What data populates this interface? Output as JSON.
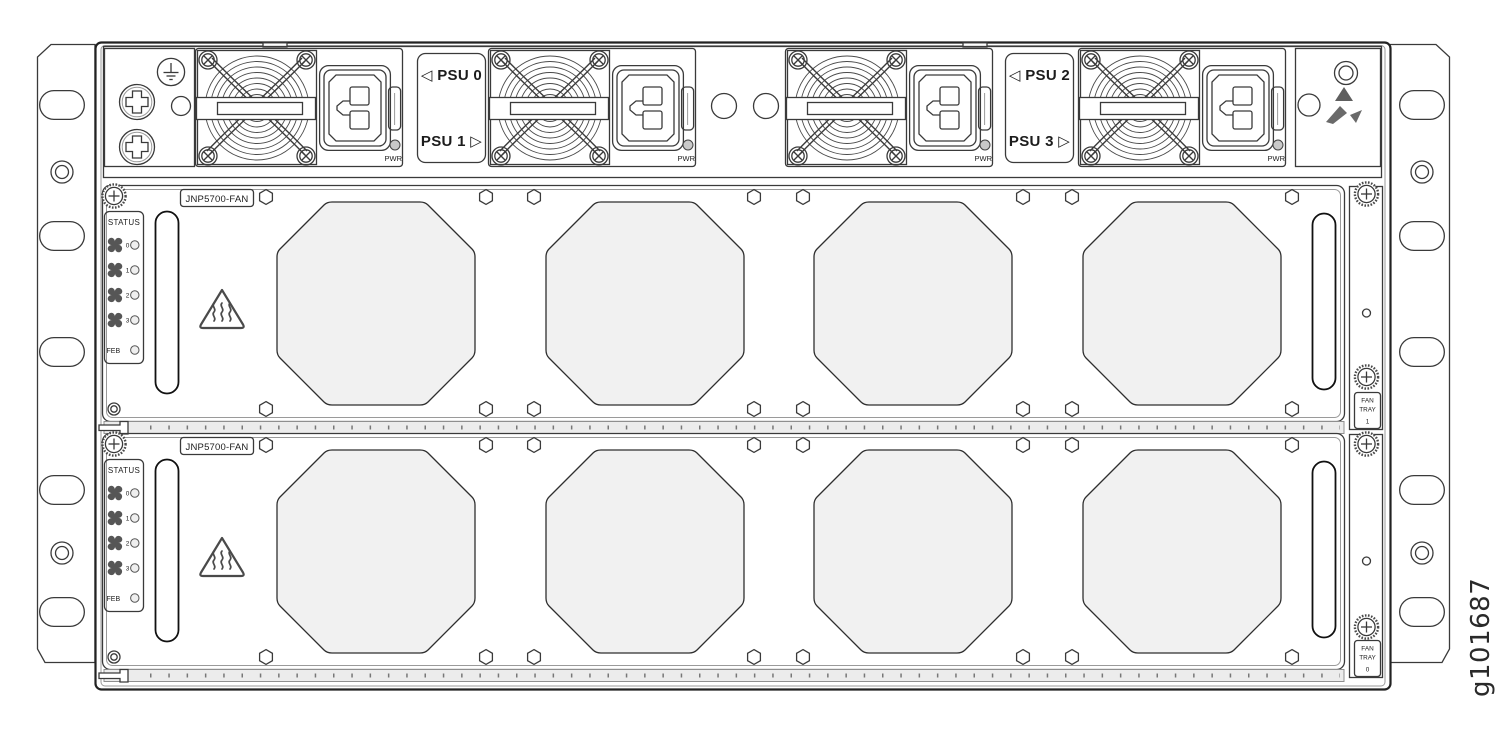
{
  "figure": {
    "id": "g101687"
  },
  "colors": {
    "line": "#3a3a3a",
    "chassis_border": "#222222",
    "vent_fill": "#f1f1f1",
    "rail_fill": "#ececec",
    "pwr_led_fill": "#c9c9c9",
    "icon_gray": "#5f5f5f",
    "background": "#ffffff"
  },
  "psu_section": {
    "pwr_led_label": "PWR",
    "label_plates": [
      {
        "top": "◁ PSU 0",
        "bottom": "PSU 1 ▷"
      },
      {
        "top": "◁ PSU 2",
        "bottom": "PSU 3 ▷"
      }
    ]
  },
  "fan_trays": [
    {
      "model_label": "JNP5700-FAN",
      "status": {
        "title": "STATUS",
        "fan_ids": [
          "0",
          "1",
          "2",
          "3"
        ],
        "feb_label": "FEB"
      },
      "tray_tag": {
        "line1": "FAN",
        "line2": "TRAY",
        "line3": "1"
      }
    },
    {
      "model_label": "JNP5700-FAN",
      "status": {
        "title": "STATUS",
        "fan_ids": [
          "0",
          "1",
          "2",
          "3"
        ],
        "feb_label": "FEB"
      },
      "tray_tag": {
        "line1": "FAN",
        "line2": "TRAY",
        "line3": "0"
      }
    }
  ]
}
